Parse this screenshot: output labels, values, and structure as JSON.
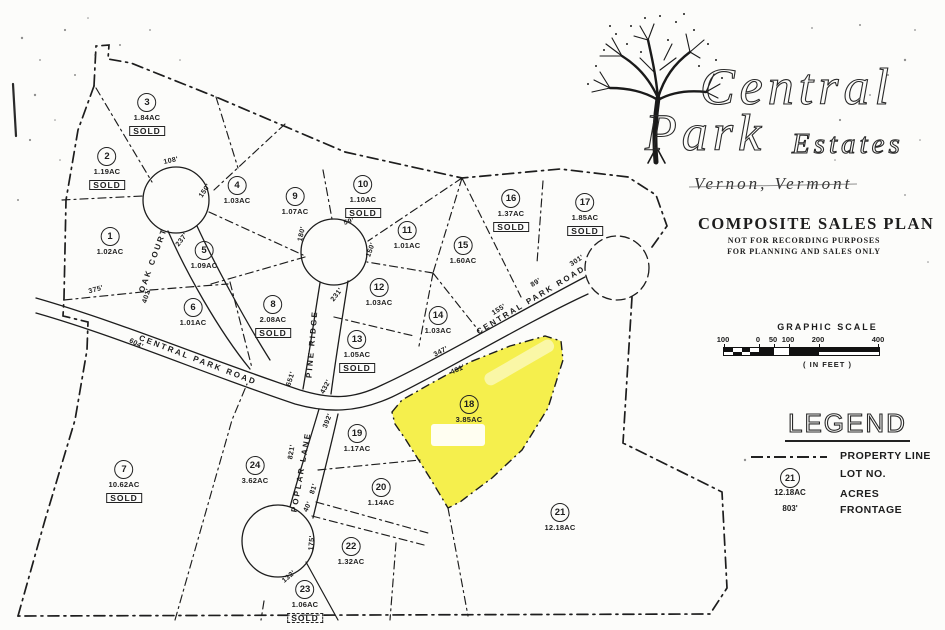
{
  "title_block": {
    "brand_line1": "Central",
    "brand_line2": "Park",
    "brand_suffix": "Estates",
    "location": "Vernon, Vermont",
    "plan_title": "COMPOSITE SALES PLAN",
    "plan_note1": "NOT FOR RECORDING PURPOSES",
    "plan_note2": "FOR PLANNING AND SALES ONLY"
  },
  "graphic_scale": {
    "title": "GRAPHIC SCALE",
    "ticks": [
      "100",
      "0",
      "50",
      "100",
      "200",
      "400"
    ],
    "units_note": "( IN FEET )"
  },
  "legend": {
    "title": "LEGEND",
    "entries": [
      {
        "symbol": "dash-dot-line",
        "label": "PROPERTY LINE"
      },
      {
        "symbol": "21",
        "label": "LOT NO."
      },
      {
        "symbol": "12.18AC",
        "label": "ACRES"
      },
      {
        "symbol": "803'",
        "label": "FRONTAGE"
      }
    ]
  },
  "roads": [
    {
      "name": "OAK COURT",
      "x": 153,
      "y": 260,
      "rot": -70
    },
    {
      "name": "CENTRAL PARK ROAD",
      "x": 198,
      "y": 360,
      "rot": 21
    },
    {
      "name": "CENTRAL PARK ROAD",
      "x": 531,
      "y": 300,
      "rot": -31
    },
    {
      "name": "PINE RIDGE",
      "x": 312,
      "y": 344,
      "rot": -85
    },
    {
      "name": "POPLAR LANE",
      "x": 301,
      "y": 472,
      "rot": -80
    }
  ],
  "lots": [
    {
      "num": "1",
      "acres": "1.02AC",
      "x": 110,
      "y": 237
    },
    {
      "num": "2",
      "acres": "1.19AC",
      "sold_label": "SOLD",
      "x": 107,
      "y": 157
    },
    {
      "num": "3",
      "acres": "1.84AC",
      "sold_label": "SOLD",
      "x": 147,
      "y": 103
    },
    {
      "num": "4",
      "acres": "1.03AC",
      "x": 237,
      "y": 186
    },
    {
      "num": "5",
      "acres": "1.09AC",
      "x": 204,
      "y": 251
    },
    {
      "num": "6",
      "acres": "1.01AC",
      "x": 193,
      "y": 308
    },
    {
      "num": "7",
      "acres": "10.62AC",
      "sold_label": "SOLD",
      "x": 124,
      "y": 470
    },
    {
      "num": "8",
      "acres": "2.08AC",
      "sold_label": "SOLD",
      "x": 273,
      "y": 305
    },
    {
      "num": "9",
      "acres": "1.07AC",
      "x": 295,
      "y": 197
    },
    {
      "num": "10",
      "acres": "1.10AC",
      "sold_label": "SOLD",
      "x": 363,
      "y": 185
    },
    {
      "num": "11",
      "acres": "1.01AC",
      "x": 407,
      "y": 231
    },
    {
      "num": "12",
      "acres": "1.03AC",
      "x": 379,
      "y": 288
    },
    {
      "num": "13",
      "acres": "1.05AC",
      "sold_label": "SOLD",
      "x": 357,
      "y": 340
    },
    {
      "num": "14",
      "acres": "1.03AC",
      "x": 438,
      "y": 316
    },
    {
      "num": "15",
      "acres": "1.60AC",
      "x": 463,
      "y": 246
    },
    {
      "num": "16",
      "acres": "1.37AC",
      "sold_label": "SOLD",
      "x": 511,
      "y": 199
    },
    {
      "num": "17",
      "acres": "1.85AC",
      "sold_label": "SOLD",
      "x": 585,
      "y": 203
    },
    {
      "num": "18",
      "acres": "3.85AC",
      "x": 469,
      "y": 405,
      "highlight": true
    },
    {
      "num": "19",
      "acres": "1.17AC",
      "x": 357,
      "y": 434
    },
    {
      "num": "20",
      "acres": "1.14AC",
      "x": 381,
      "y": 488
    },
    {
      "num": "21",
      "acres": "12.18AC",
      "x": 560,
      "y": 513
    },
    {
      "num": "22",
      "acres": "1.32AC",
      "x": 351,
      "y": 547
    },
    {
      "num": "23",
      "acres": "1.06AC",
      "sold_label": "SOLD",
      "sold_style": "dashed",
      "x": 305,
      "y": 590
    },
    {
      "num": "24",
      "acres": "3.62AC",
      "x": 255,
      "y": 466
    }
  ],
  "dimensions": [
    {
      "text": "108'",
      "x": 171,
      "y": 161,
      "rot": -12
    },
    {
      "text": "150'",
      "x": 205,
      "y": 191,
      "rot": -55
    },
    {
      "text": "237'",
      "x": 182,
      "y": 240,
      "rot": -52
    },
    {
      "text": "375'",
      "x": 96,
      "y": 290,
      "rot": -15
    },
    {
      "text": "401'",
      "x": 147,
      "y": 296,
      "rot": -72
    },
    {
      "text": "604'",
      "x": 136,
      "y": 344,
      "rot": 28
    },
    {
      "text": "651'",
      "x": 291,
      "y": 379,
      "rot": -72
    },
    {
      "text": "59'",
      "x": 349,
      "y": 222,
      "rot": -15
    },
    {
      "text": "180'",
      "x": 302,
      "y": 234,
      "rot": -78
    },
    {
      "text": "150'",
      "x": 371,
      "y": 250,
      "rot": -70
    },
    {
      "text": "231'",
      "x": 337,
      "y": 295,
      "rot": -52
    },
    {
      "text": "432'",
      "x": 326,
      "y": 387,
      "rot": -62
    },
    {
      "text": "392'",
      "x": 328,
      "y": 421,
      "rot": -68
    },
    {
      "text": "821'",
      "x": 292,
      "y": 452,
      "rot": -80
    },
    {
      "text": "81'",
      "x": 314,
      "y": 489,
      "rot": -72
    },
    {
      "text": "40'",
      "x": 308,
      "y": 507,
      "rot": -65
    },
    {
      "text": "175'",
      "x": 312,
      "y": 543,
      "rot": -85
    },
    {
      "text": "132'",
      "x": 289,
      "y": 577,
      "rot": -40
    },
    {
      "text": "347'",
      "x": 441,
      "y": 352,
      "rot": -27
    },
    {
      "text": "481'",
      "x": 458,
      "y": 370,
      "rot": -24
    },
    {
      "text": "155'",
      "x": 499,
      "y": 310,
      "rot": -32
    },
    {
      "text": "89'",
      "x": 536,
      "y": 283,
      "rot": -32
    },
    {
      "text": "301'",
      "x": 577,
      "y": 261,
      "rot": -33
    }
  ],
  "colors": {
    "highlight_yellow": "#f4ee3e",
    "ink": "#1d1d1d",
    "paper": "#fcfcfa"
  }
}
